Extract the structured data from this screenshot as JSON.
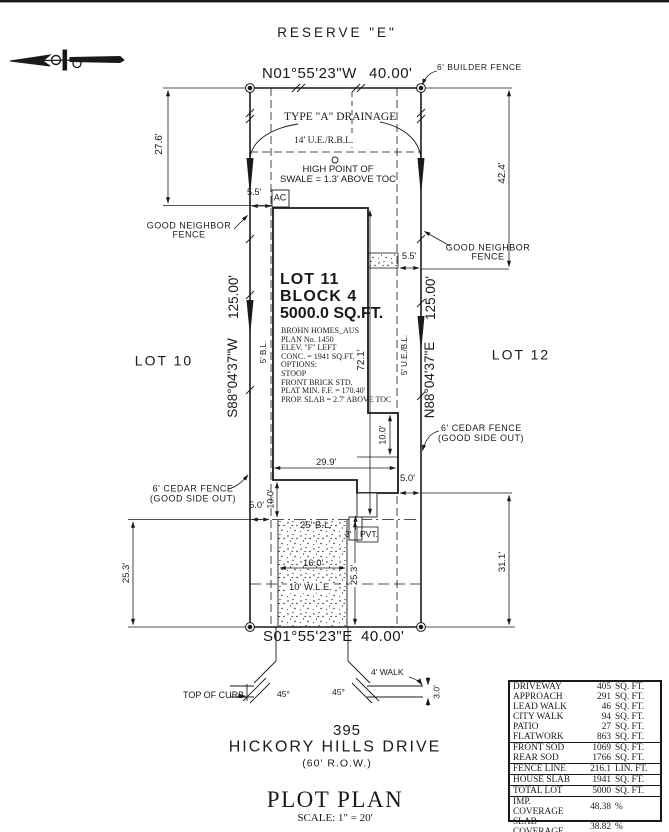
{
  "page": {
    "reserve_label": "RESERVE \"E\"",
    "north_arrow_icon": "north-arrow"
  },
  "boundary": {
    "bearing_top": "N01°55'23\"W",
    "len_top": "40.00'",
    "bearing_bottom": "S01°55'23\"E",
    "len_bottom": "40.00'",
    "bearing_left": "S88°04'37\"W",
    "len_left": "125.00'",
    "bearing_right": "N88°04'37\"E",
    "len_right": "125.00'"
  },
  "lot": {
    "number": "LOT 11",
    "block": "BLOCK 4",
    "area": "5000.0 SQ.FT.",
    "left_neighbor": "LOT 10",
    "right_neighbor": "LOT 12",
    "details": [
      "BROHN HOMES_AUS",
      "PLAN No. 1450",
      "ELEV. \"F\" LEFT",
      "CONC. = 1941 SQ.FT.",
      "OPTIONS:",
      "STOOP",
      "FRONT BRICK STD.",
      "PLAT MIN. F.F. = 170.40'",
      "PROP. SLAB = 2.7' ABOVE TOC"
    ]
  },
  "fences": {
    "builder": "6' BUILDER FENCE",
    "good_neighbor_1": "GOOD NEIGHBOR",
    "good_neighbor_2": "FENCE",
    "cedar_1": "6' CEDAR FENCE",
    "cedar_2": "(GOOD SIDE OUT)"
  },
  "notes": {
    "drainage": "TYPE \"A\" DRAINAGE",
    "ue_rbl": "14' U.E./R.B.L.",
    "high_point_1": "HIGH POINT OF",
    "high_point_2": "SWALE = 1.3' ABOVE TOC",
    "ac": "AC",
    "bl_5": "5' B.L.",
    "ue_bl_5": "5' U.E./B.L.",
    "bl_25": "25' B.L.",
    "wle_10": "10' W.L.E.",
    "pvt_3": "3'",
    "pvt": "PVT.",
    "walk_4": "4' WALK",
    "top_of_curb": "TOP OF CURB",
    "angle_left": "45°",
    "angle_right": "45°"
  },
  "dimensions": {
    "d27_6": "27.6'",
    "d42_4": "42.4'",
    "d5_5_top": "5.5'",
    "d5_5_right": "5.5'",
    "d72_1": "72.1'",
    "d10_0_left": "10.0'",
    "d10_0_right": "10.0'",
    "d29_9": "29.9'",
    "d5_0_left": "5.0'",
    "d5_0_right": "5.0'",
    "d25_3_left": "25.3'",
    "d25_3_mid": "25.3'",
    "d16_0": "16.0'",
    "d31_1": "31.1'",
    "d3_0": "3.0'"
  },
  "address": {
    "number": "395",
    "street": "HICKORY HILLS DRIVE",
    "row": "(60' R.O.W.)"
  },
  "titleblock": {
    "title": "PLOT PLAN",
    "scale": "SCALE: 1\" = 20'"
  },
  "site_table": {
    "rows": [
      {
        "label": "DRIVEWAY",
        "value": "405",
        "unit": "SQ. FT."
      },
      {
        "label": "APPROACH",
        "value": "291",
        "unit": "SQ. FT."
      },
      {
        "label": "LEAD WALK",
        "value": "46",
        "unit": "SQ. FT."
      },
      {
        "label": "CITY WALK",
        "value": "94",
        "unit": "SQ. FT."
      },
      {
        "label": "PATIO",
        "value": "27",
        "unit": "SQ. FT."
      },
      {
        "label": "FLATWORK",
        "value": "863",
        "unit": "SQ. FT."
      },
      {
        "label": "FRONT SOD",
        "value": "1069",
        "unit": "SQ. FT."
      },
      {
        "label": "REAR SOD",
        "value": "1766",
        "unit": "SQ. FT."
      },
      {
        "label": "FENCE LINE",
        "value": "216.1",
        "unit": "LIN. FT."
      },
      {
        "label": "HOUSE SLAB",
        "value": "1941",
        "unit": "SQ. FT."
      },
      {
        "label": "TOTAL LOT",
        "value": "5000",
        "unit": "SQ. FT."
      },
      {
        "label": "IMP. COVERAGE",
        "value": "48.38",
        "unit": "%"
      },
      {
        "label": "SLAB COVERAGE",
        "value": "38.82",
        "unit": "%"
      }
    ]
  },
  "colors": {
    "ink": "#1a1a1a",
    "paper": "#ffffff"
  }
}
